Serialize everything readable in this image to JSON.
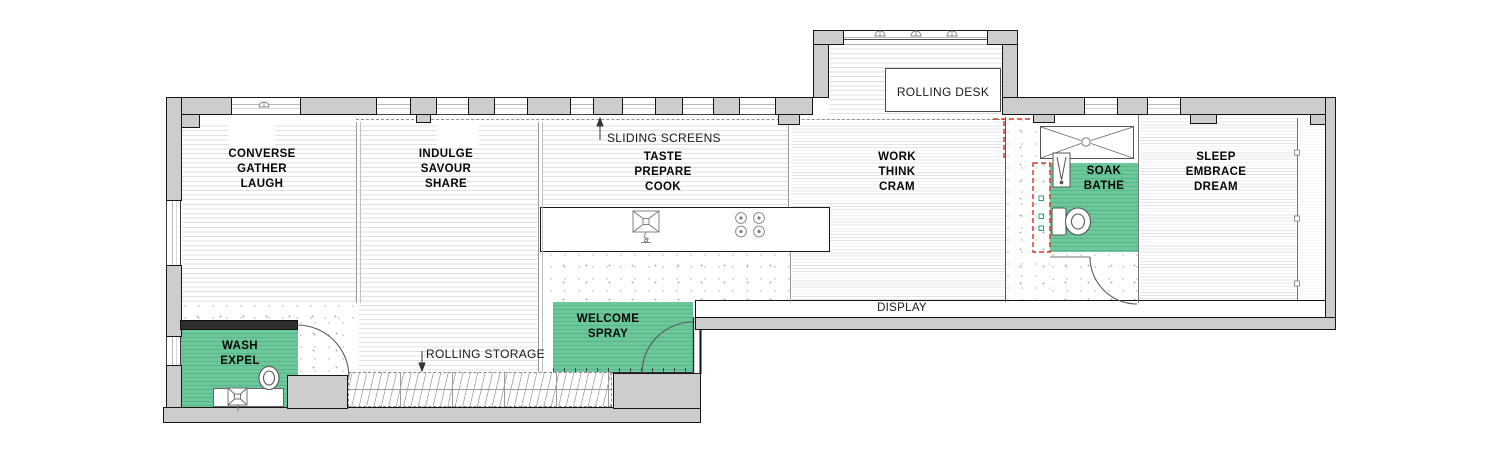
{
  "plan_title": "apartment floor plan",
  "rooms": [
    {
      "name": "living",
      "lines": [
        "CONVERSE",
        "GATHER",
        "LAUGH"
      ]
    },
    {
      "name": "dining",
      "lines": [
        "INDULGE",
        "SAVOUR",
        "SHARE"
      ]
    },
    {
      "name": "kitchen",
      "lines": [
        "TASTE",
        "PREPARE",
        "COOK"
      ]
    },
    {
      "name": "office",
      "lines": [
        "WORK",
        "THINK",
        "CRAM"
      ]
    },
    {
      "name": "bedroom",
      "lines": [
        "SLEEP",
        "EMBRACE",
        "DREAM"
      ]
    },
    {
      "name": "bathroom",
      "lines": [
        "SOAK",
        "BATHE"
      ]
    },
    {
      "name": "wc",
      "lines": [
        "WASH",
        "EXPEL"
      ]
    },
    {
      "name": "entry",
      "lines": [
        "WELCOME",
        "SPRAY"
      ]
    }
  ],
  "callouts": {
    "rolling_desk": "ROLLING DESK",
    "sliding_screens": "SLIDING SCREENS",
    "rolling_storage": "ROLLING STORAGE",
    "display": "DISPLAY"
  },
  "fixtures": [
    "bathtub",
    "shower",
    "toilet",
    "sink",
    "cooktop",
    "wardrobe",
    "door-swing",
    "window-crank"
  ],
  "colors": {
    "wall_fill": "#cdcdcd",
    "wall_line": "#161616",
    "accent_green": "#6cc79a",
    "dashed_red": "#d8382c"
  }
}
